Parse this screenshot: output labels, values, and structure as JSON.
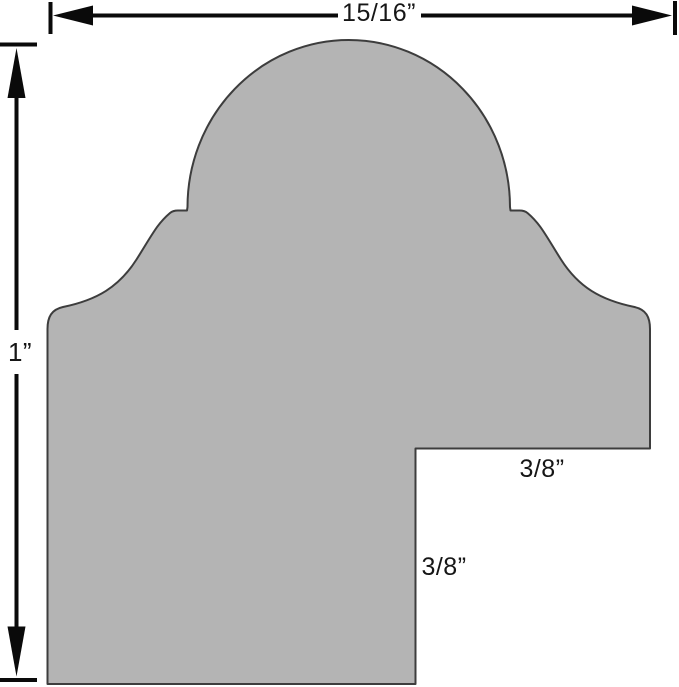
{
  "diagram": {
    "shape": "moulding-profile-cross-section"
  },
  "labels": {
    "overall_width": "15/16”",
    "overall_height": "1”",
    "rabbet_depth": "3/8”",
    "rabbet_height": "3/8”"
  },
  "colors": {
    "profile_fill": "#b4b4b4",
    "profile_outline": "#3d3d3d",
    "dimension_lines": "#0a0a0a",
    "background": "#ffffff"
  }
}
